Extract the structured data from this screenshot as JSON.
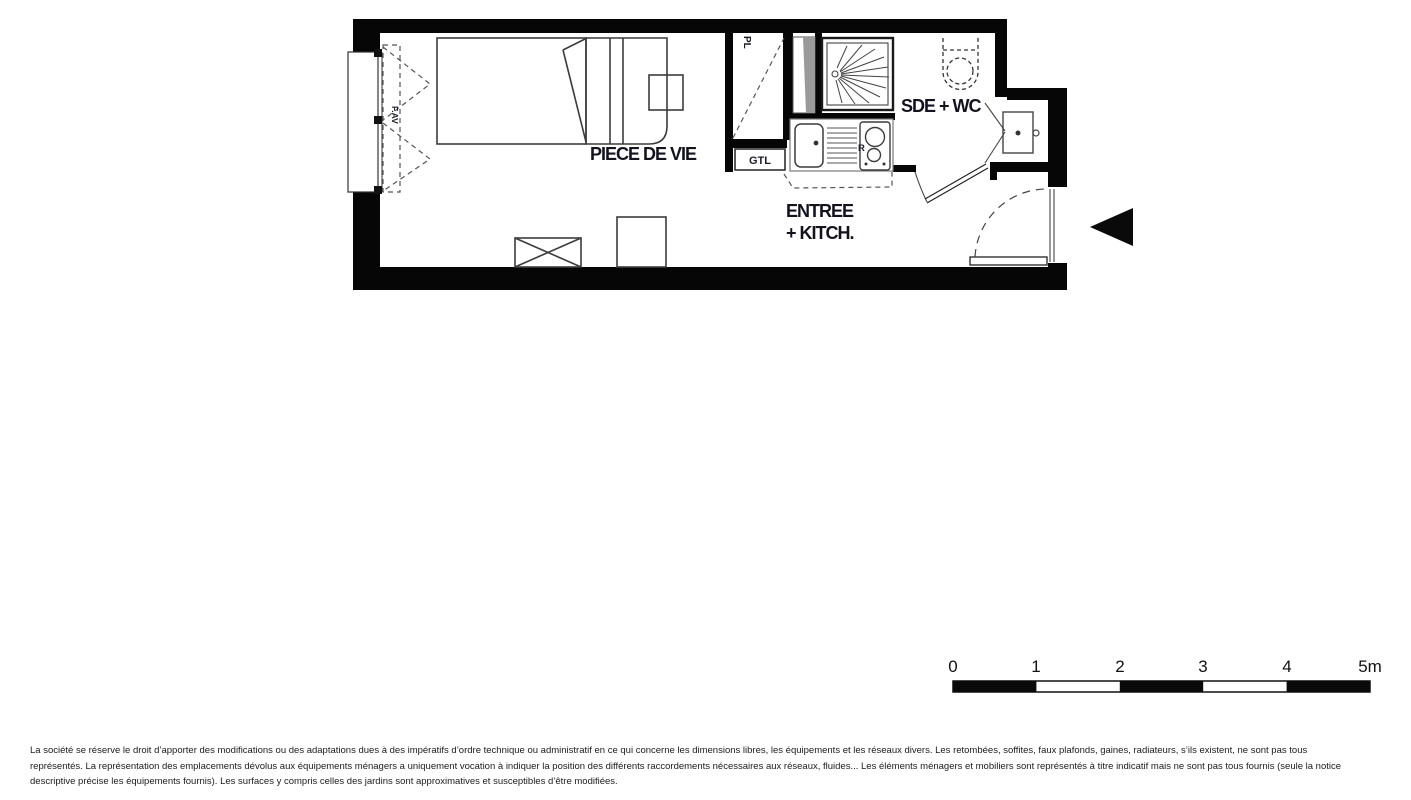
{
  "plan": {
    "rooms": {
      "living": "PIECE DE VIE",
      "entry_line1": "ENTREE",
      "entry_line2": "+ KITCH.",
      "bathroom": "SDE + WC",
      "closet": "PL",
      "duct_box": "GTL",
      "fridge": "R",
      "window": "F.AV"
    },
    "colors": {
      "wall": "#060606",
      "label": "#13131f"
    }
  },
  "scale": {
    "labels": [
      "0",
      "1",
      "2",
      "3",
      "4",
      "5m"
    ]
  },
  "disclaimer": {
    "line1": "La société se réserve le droit d’apporter des modifications ou des adaptations dues à des impératifs d’ordre technique ou administratif en ce qui concerne les dimensions libres, les équipements et les réseaux divers. Les retombées, soffites, faux plafonds, gaines, radiateurs, s’ils existent, ne sont pas tous",
    "line2": "représentés. La représentation des emplacements dévolus aux équipements ménagers a uniquement vocation à indiquer la position des différents raccordements nécessaires aux réseaux, fluides... Les éléments ménagers et mobiliers sont représentés à titre indicatif mais ne sont pas tous fournis (seule la notice",
    "line3": "descriptive précise les équipements fournis). Les surfaces y compris celles des jardins sont approximatives et susceptibles d’être modifiées."
  }
}
